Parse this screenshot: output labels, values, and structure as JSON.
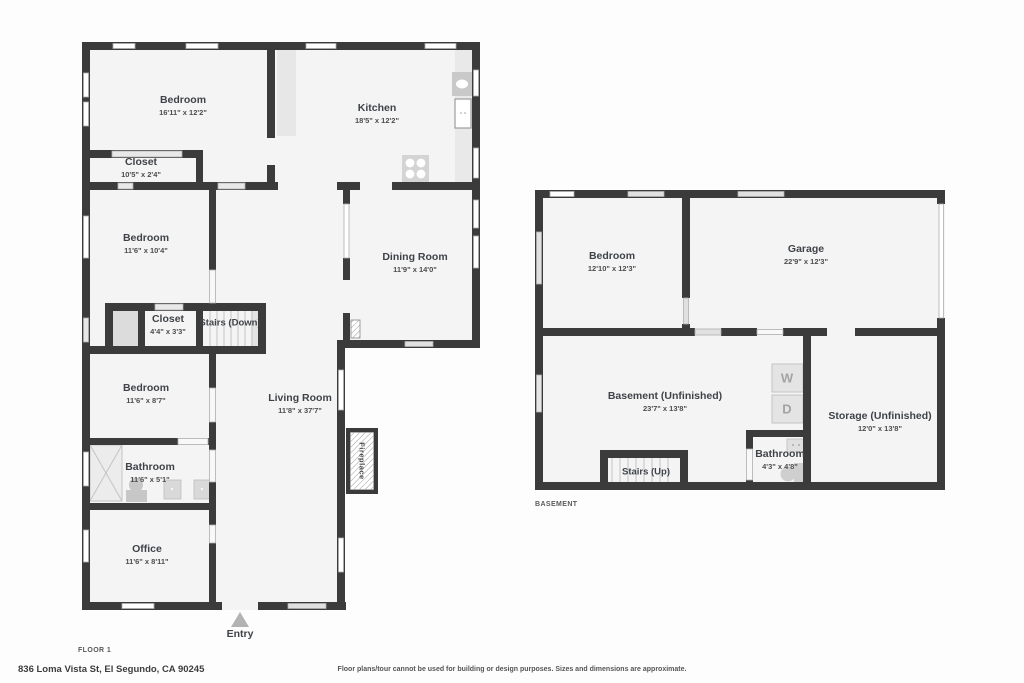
{
  "floor1": {
    "plan_label": "FLOOR 1",
    "entry_label": "Entry",
    "stairs_label": "Stairs (Down)",
    "fireplace_label": "Fireplace",
    "rooms": {
      "bedroom_top": {
        "name": "Bedroom",
        "dims": "16'11\" x 12'2\""
      },
      "kitchen": {
        "name": "Kitchen",
        "dims": "18'5\" x 12'2\""
      },
      "closet_top": {
        "name": "Closet",
        "dims": "10'5\" x 2'4\""
      },
      "bedroom_mid": {
        "name": "Bedroom",
        "dims": "11'6\" x 10'4\""
      },
      "dining": {
        "name": "Dining Room",
        "dims": "11'9\" x 14'0\""
      },
      "closet_small": {
        "name": "Closet",
        "dims": "4'4\" x 3'3\""
      },
      "bedroom_low": {
        "name": "Bedroom",
        "dims": "11'6\" x 8'7\""
      },
      "living": {
        "name": "Living Room",
        "dims": "11'8\" x 37'7\""
      },
      "bathroom": {
        "name": "Bathroom",
        "dims": "11'6\" x 5'1\""
      },
      "office": {
        "name": "Office",
        "dims": "11'6\" x 8'11\""
      }
    }
  },
  "basement": {
    "plan_label": "BASEMENT",
    "stairs_label": "Stairs (Up)",
    "washer_label": "W",
    "dryer_label": "D",
    "rooms": {
      "bedroom": {
        "name": "Bedroom",
        "dims": "12'10\" x 12'3\""
      },
      "garage": {
        "name": "Garage",
        "dims": "22'9\" x 12'3\""
      },
      "basement_room": {
        "name": "Basement (Unfinished)",
        "dims": "23'7\" x 13'8\""
      },
      "storage": {
        "name": "Storage (Unfinished)",
        "dims": "12'0\" x 13'8\""
      },
      "bathroom": {
        "name": "Bathroom",
        "dims": "4'3\" x 4'8\""
      }
    }
  },
  "footer": {
    "address": "836 Loma Vista St, El Segundo, CA 90245",
    "disclaimer": "Floor plans/tour cannot be used for building or design purposes. Sizes and dimensions are approximate."
  },
  "colors": {
    "wall": "#3b3b3b",
    "interior": "#f4f4f4",
    "fixture": "#d9d9d9",
    "label_text": "#3f4348"
  }
}
